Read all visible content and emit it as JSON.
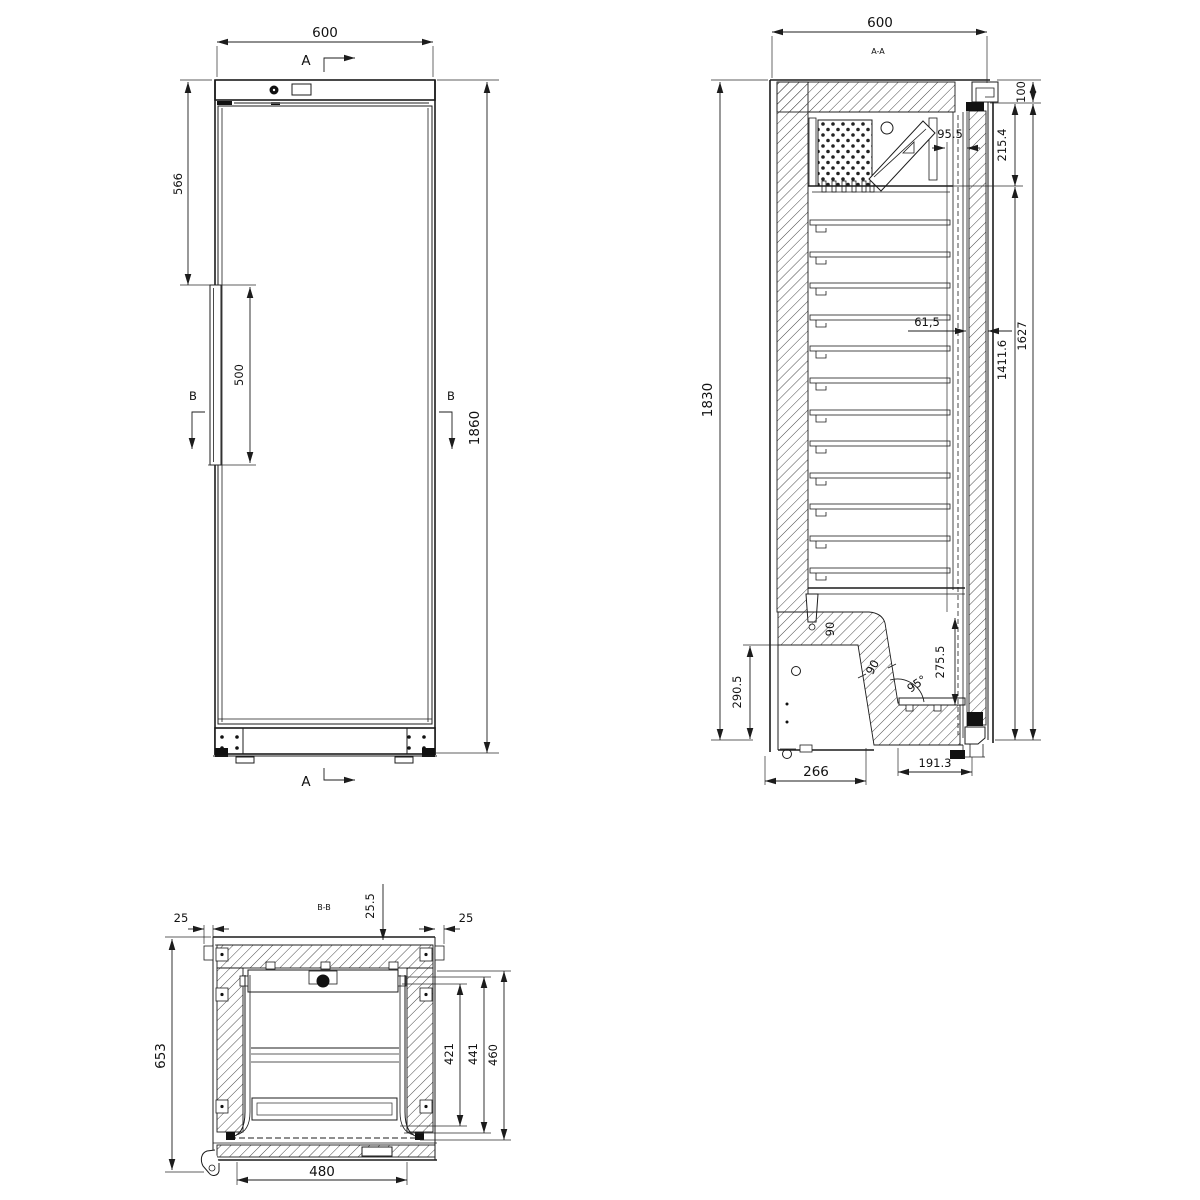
{
  "drawing": {
    "background": "#ffffff",
    "line_color": "#1c1c1c",
    "front_view": {
      "section_arrow_top": "A",
      "section_arrow_bottom": "A",
      "section_arrow_left": "B",
      "section_arrow_right": "B",
      "dim_width": "600",
      "dim_top_to_handle": "566",
      "dim_handle_length": "500",
      "dim_overall_height": "1860"
    },
    "side_section_view": {
      "label": "A-A",
      "dim_width": "600",
      "dim_overall_height": "1830",
      "dim_top_hinge": "100",
      "dim_evaporator_width": "95.5",
      "dim_evaporator_zone": "215.4",
      "dim_door_thickness": "61,5",
      "dim_interior_height": "1627",
      "dim_shelf_zone": "1411.6",
      "dim_compressor_zone": "290.5",
      "dim_compressor_depth": "266",
      "dim_front_clearance": "191.3",
      "dim_bottom_front_height": "275.5",
      "dim_base_angle": "95°",
      "dim_floor_thickness": "90",
      "dim_ramp_thickness": "90"
    },
    "plan_section_view": {
      "label": "B-B",
      "dim_top_wall": "25.5",
      "dim_side_left": "25",
      "dim_side_right": "25",
      "dim_overall_depth": "653",
      "dim_depth_to_shelf_front": "421",
      "dim_depth_to_liner_front": "441",
      "dim_depth_to_door": "460",
      "dim_door_opening_width": "480"
    }
  }
}
